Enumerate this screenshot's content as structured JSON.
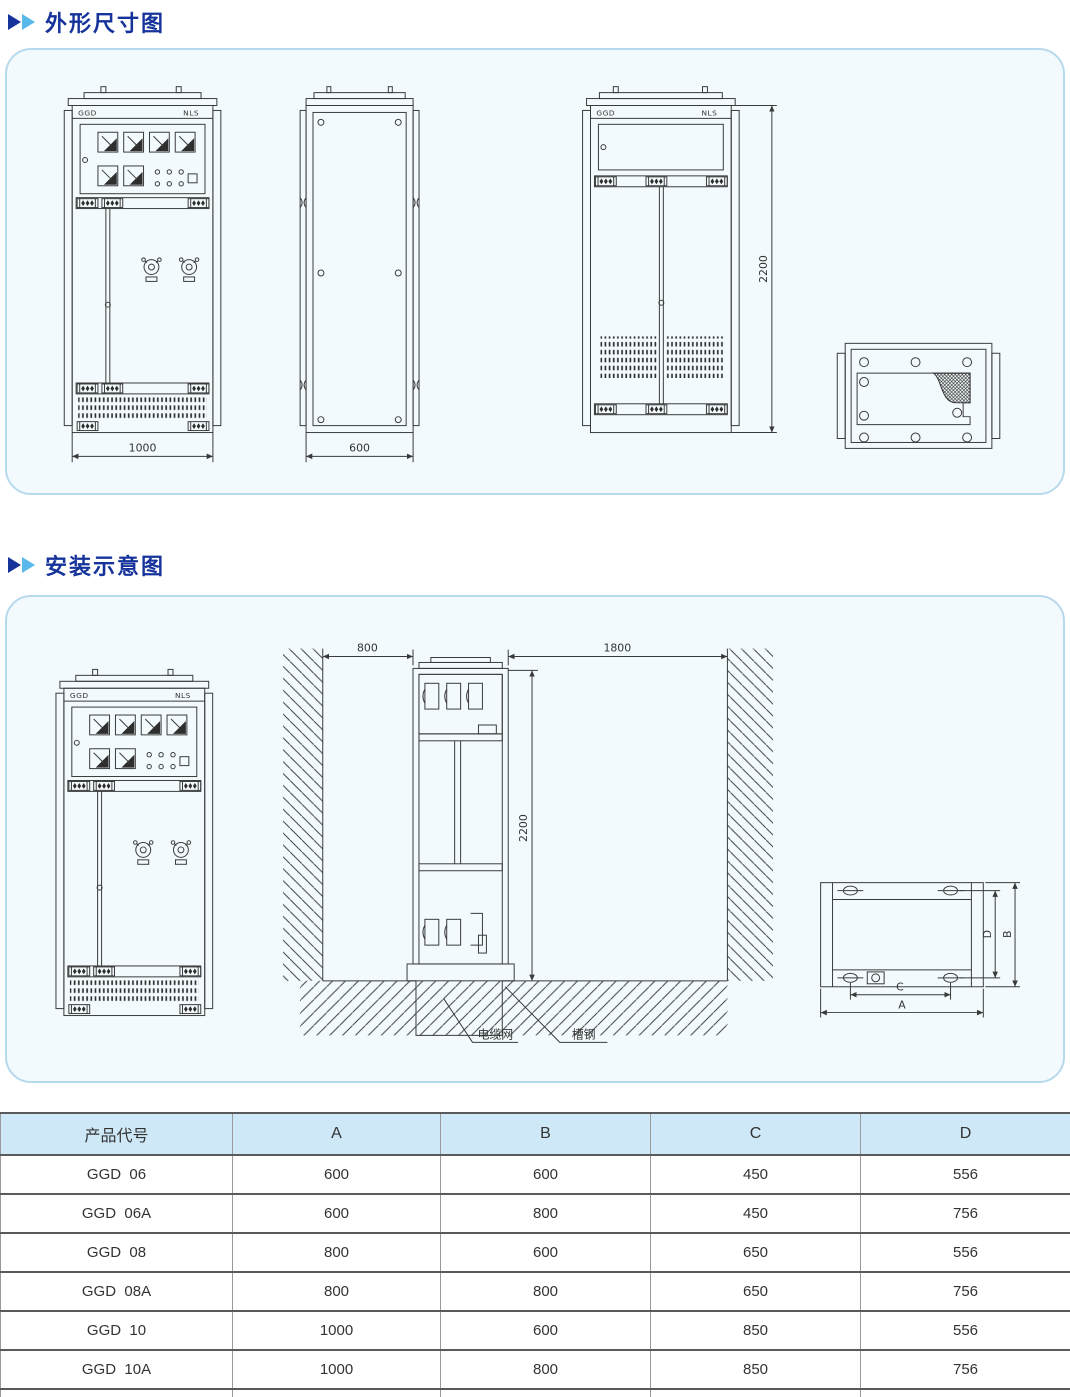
{
  "page": {
    "section1_title": "外形尺寸图",
    "section2_title": "安装示意图"
  },
  "colors": {
    "accent_dark": "#16339b",
    "accent_light": "#58b9ea",
    "panel_bg": "#f3fafd",
    "panel_border": "#b7d9ee",
    "table_header_bg": "#cfe8f7"
  },
  "drawings": {
    "brand_left": "GGD",
    "brand_right": "NLS",
    "front_width": "1000",
    "side_depth": "600",
    "rear_height": "2200",
    "install": {
      "left_gap": "800",
      "right_gap": "1800",
      "height": "2200",
      "label_cable_net": "电缆网",
      "label_channel_steel": "槽钢"
    },
    "mounting": {
      "dim_a": "A",
      "dim_b": "B",
      "dim_c": "C",
      "dim_d": "D"
    }
  },
  "table": {
    "headers": [
      "产品代号",
      "A",
      "B",
      "C",
      "D"
    ],
    "rows": [
      [
        "GGD  06",
        "600",
        "600",
        "450",
        "556"
      ],
      [
        "GGD  06A",
        "600",
        "800",
        "450",
        "756"
      ],
      [
        "GGD  08",
        "800",
        "600",
        "650",
        "556"
      ],
      [
        "GGD  08A",
        "800",
        "800",
        "650",
        "756"
      ],
      [
        "GGD  10",
        "1000",
        "600",
        "850",
        "556"
      ],
      [
        "GGD  10A",
        "1000",
        "800",
        "850",
        "756"
      ],
      [
        "GGD  12",
        "1200",
        "800",
        "1050",
        "756"
      ]
    ]
  }
}
